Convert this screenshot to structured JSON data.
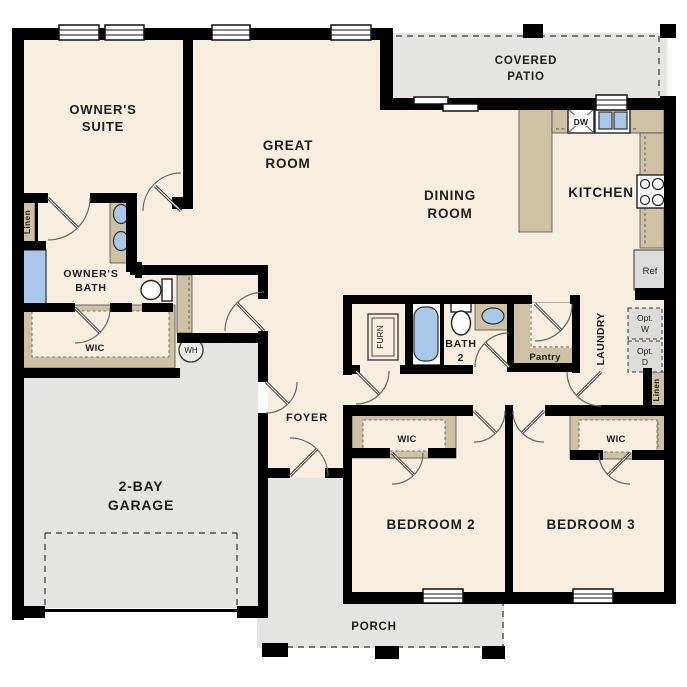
{
  "plan": {
    "rooms": {
      "owners_suite": {
        "l1": "OWNER'S",
        "l2": "SUITE"
      },
      "great_room": {
        "l1": "GREAT",
        "l2": "ROOM"
      },
      "covered_patio": {
        "l1": "COVERED",
        "l2": "PATIO"
      },
      "dining_room": {
        "l1": "DINING",
        "l2": "ROOM"
      },
      "kitchen": {
        "l1": "KITCHEN"
      },
      "owners_bath": {
        "l1": "OWNER'S",
        "l2": "BATH"
      },
      "bath2": {
        "l1": "BATH",
        "l2": "2"
      },
      "garage": {
        "l1": "2-BAY",
        "l2": "GARAGE"
      },
      "foyer": {
        "l1": "FOYER"
      },
      "bedroom2": {
        "l1": "BEDROOM 2"
      },
      "bedroom3": {
        "l1": "BEDROOM 3"
      },
      "porch": {
        "l1": "PORCH"
      },
      "laundry": {
        "l1": "LAUNDRY"
      }
    },
    "closets": {
      "owners_wic": "WIC",
      "bed2_wic": "WIC",
      "bed3_wic": "WIC",
      "linen_front": "Linen",
      "linen_hall": "Linen",
      "pantry": "Pantry"
    },
    "fixtures": {
      "dishwasher": "DW",
      "refrigerator": "Ref",
      "water_heater": "WH",
      "furnace": "FURN",
      "opt_washer": {
        "l1": "Opt.",
        "l2": "W"
      },
      "opt_dryer": {
        "l1": "Opt.",
        "l2": "D"
      }
    },
    "colors": {
      "floor": "#f7eee0",
      "wall": "#000000",
      "casework_tan": "#cfc2a4",
      "concrete_gray": "#e4e4e2",
      "fixture_blue": "#a9c7e8",
      "appliance_gray": "#dcdcda"
    }
  }
}
